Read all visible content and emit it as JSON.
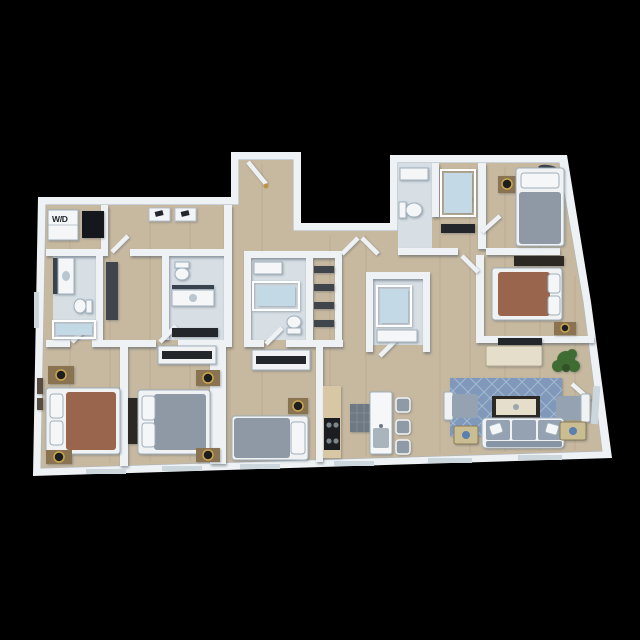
{
  "labels": {
    "washer_dryer": "W/D"
  },
  "unit": {
    "view": "3d-rendered floor plan on black background",
    "bedrooms": 5,
    "bathrooms": 5,
    "rooms": [
      "entry foyer",
      "laundry corridor",
      "hallway",
      "kitchen",
      "living room",
      "bedroom 1",
      "bedroom 2",
      "bedroom 3",
      "bedroom 4",
      "bedroom 5",
      "bathrooms",
      "closets"
    ],
    "furniture": [
      "washer-dryer",
      "coat hooks",
      "beds with nightstands and lamps",
      "wall dressers",
      "closet shelving",
      "bathtubs",
      "showers",
      "toilets",
      "vanities",
      "kitchen island with bar stools",
      "range",
      "sofa",
      "armchairs",
      "coffee table",
      "side tables",
      "console with tv",
      "patterned area rug",
      "potted plant",
      "framed wall art",
      "windows"
    ]
  },
  "colors": {
    "background": "#000000",
    "wall": "#eef2f5",
    "floorWood": "#c7b9a0",
    "floorWoodLine": "#9b8a6e",
    "tile": "#d7dfe5",
    "linen": "#f0f2f4",
    "bedBrown": "#99664d",
    "bedGray": "#8e99a5",
    "rug": "#8099bb",
    "rugLight": "#aebfd6",
    "sofa": "#94a2b1",
    "stool": "#8f9aa7",
    "woodFurn": "#8a7350",
    "woodDark": "#2c2824",
    "lampBlack": "#1c1e20",
    "counterTan": "#d8c7a4",
    "applianceDark": "#1b1d20",
    "applianceGray": "#6e7983",
    "island": "#f5f7f8",
    "tubBlue": "#c3d9e6",
    "fixtureWhite": "#f4f6f8",
    "consoleCream": "#e5decb",
    "tableCream": "#cbbd92",
    "tvDark": "#23272c",
    "plant": "#3f6c33",
    "plantDark": "#2f5226",
    "windowGlass": "#ccd6dd",
    "doorway": "#14181c",
    "mirror": "#39434e",
    "shelfDark": "#40454c",
    "clothesDark": "#23262b",
    "decorBlue": "#5b7fae",
    "artFrame": "#564c41"
  }
}
